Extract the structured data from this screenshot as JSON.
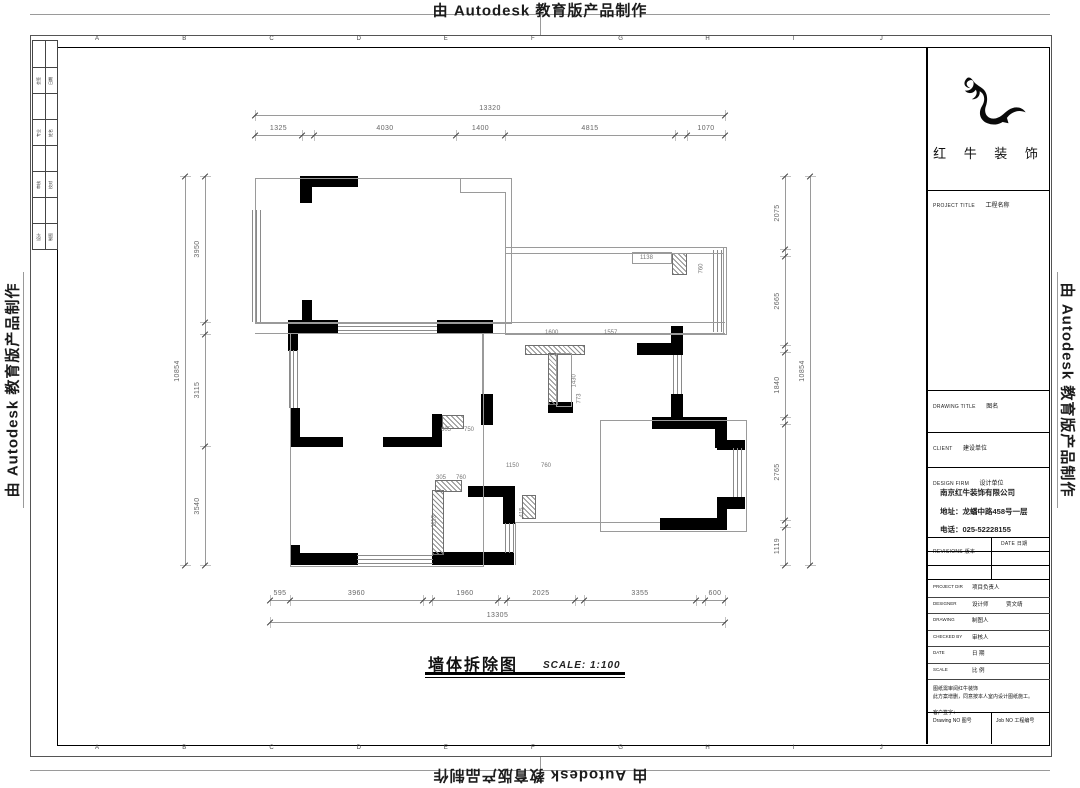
{
  "stamp_text": "由 Autodesk 教育版产品制作",
  "frame": {
    "grid_letters": [
      "A",
      "B",
      "C",
      "D",
      "E",
      "F",
      "G",
      "H",
      "I",
      "J"
    ],
    "side_rows": [
      [
        "会签",
        "日期"
      ],
      [
        "专业",
        "姓名"
      ],
      [
        "审核",
        "校对"
      ],
      [
        "设计",
        "制图"
      ]
    ]
  },
  "plan": {
    "title": "墙体拆除图",
    "scale_label": "SCALE: 1:100",
    "dim_chains": [
      {
        "dir": "h",
        "pos": 115,
        "ticks": [
          255,
          725
        ],
        "spans": [
          {
            "a": 255,
            "b": 725,
            "t": "13320"
          }
        ]
      },
      {
        "dir": "h",
        "pos": 135,
        "ticks": [
          255,
          302,
          314,
          456,
          505,
          675,
          687,
          725
        ],
        "spans": [
          {
            "a": 255,
            "b": 302,
            "t": "1325"
          },
          {
            "a": 314,
            "b": 456,
            "t": "4030"
          },
          {
            "a": 456,
            "b": 505,
            "t": "1400"
          },
          {
            "a": 505,
            "b": 675,
            "t": "4815"
          },
          {
            "a": 687,
            "b": 725,
            "t": "1070"
          }
        ]
      },
      {
        "dir": "h",
        "pos": 600,
        "ticks": [
          270,
          290,
          423,
          432,
          498,
          507,
          575,
          584,
          696,
          705,
          725
        ],
        "spans": [
          {
            "a": 270,
            "b": 290,
            "t": "595"
          },
          {
            "a": 290,
            "b": 423,
            "t": "3960"
          },
          {
            "a": 432,
            "b": 498,
            "t": "1960"
          },
          {
            "a": 507,
            "b": 575,
            "t": "2025"
          },
          {
            "a": 584,
            "b": 696,
            "t": "3355"
          },
          {
            "a": 705,
            "b": 725,
            "t": "600"
          }
        ]
      },
      {
        "dir": "h",
        "pos": 622,
        "ticks": [
          270,
          725
        ],
        "spans": [
          {
            "a": 270,
            "b": 725,
            "t": "13305"
          }
        ]
      },
      {
        "dir": "v",
        "pos": 185,
        "ticks": [
          176,
          565
        ],
        "spans": [
          {
            "a": 176,
            "b": 565,
            "t": "10854"
          }
        ]
      },
      {
        "dir": "v",
        "pos": 205,
        "ticks": [
          176,
          322,
          334,
          446,
          565
        ],
        "spans": [
          {
            "a": 176,
            "b": 322,
            "t": "3950"
          },
          {
            "a": 334,
            "b": 446,
            "t": "3115"
          },
          {
            "a": 446,
            "b": 565,
            "t": "3540"
          }
        ]
      },
      {
        "dir": "v",
        "pos": 785,
        "ticks": [
          176,
          249,
          256,
          345,
          352,
          417,
          424,
          520,
          527,
          565
        ],
        "spans": [
          {
            "a": 176,
            "b": 249,
            "t": "2075"
          },
          {
            "a": 256,
            "b": 345,
            "t": "2665"
          },
          {
            "a": 352,
            "b": 417,
            "t": "1840"
          },
          {
            "a": 424,
            "b": 520,
            "t": "2765"
          },
          {
            "a": 527,
            "b": 565,
            "t": "1119"
          }
        ]
      },
      {
        "dir": "v",
        "pos": 810,
        "ticks": [
          176,
          565
        ],
        "spans": [
          {
            "a": 176,
            "b": 565,
            "t": "10854"
          }
        ]
      }
    ],
    "inner_dims": [
      {
        "x": 545,
        "y": 330,
        "t": "1600"
      },
      {
        "x": 604,
        "y": 330,
        "t": "1557"
      },
      {
        "x": 563,
        "y": 372,
        "t": "1430",
        "v": 1
      },
      {
        "x": 640,
        "y": 255,
        "t": "1138"
      },
      {
        "x": 690,
        "y": 258,
        "t": "760",
        "v": 1
      },
      {
        "x": 441,
        "y": 427,
        "t": "605"
      },
      {
        "x": 464,
        "y": 427,
        "t": "750"
      },
      {
        "x": 436,
        "y": 475,
        "t": "305"
      },
      {
        "x": 456,
        "y": 475,
        "t": "760"
      },
      {
        "x": 423,
        "y": 512,
        "t": "1113",
        "v": 1
      },
      {
        "x": 511,
        "y": 502,
        "t": "415",
        "v": 1
      },
      {
        "x": 506,
        "y": 463,
        "t": "1150"
      },
      {
        "x": 541,
        "y": 463,
        "t": "760"
      },
      {
        "x": 568,
        "y": 388,
        "t": "773",
        "v": 1
      }
    ],
    "geometry": {
      "solid": [
        [
          300,
          176,
          58,
          11
        ],
        [
          300,
          176,
          12,
          27
        ],
        [
          288,
          320,
          50,
          13
        ],
        [
          302,
          300,
          10,
          21
        ],
        [
          288,
          333,
          10,
          18
        ],
        [
          437,
          320,
          56,
          13
        ],
        [
          637,
          343,
          46,
          12
        ],
        [
          671,
          326,
          12,
          29
        ],
        [
          548,
          402,
          25,
          11
        ],
        [
          671,
          394,
          12,
          24
        ],
        [
          652,
          417,
          73,
          12
        ],
        [
          715,
          417,
          12,
          31
        ],
        [
          717,
          440,
          28,
          10
        ],
        [
          717,
          497,
          28,
          12
        ],
        [
          717,
          497,
          10,
          33
        ],
        [
          660,
          518,
          65,
          12
        ],
        [
          290,
          408,
          10,
          39
        ],
        [
          298,
          437,
          45,
          10
        ],
        [
          383,
          437,
          58,
          10
        ],
        [
          432,
          414,
          10,
          33
        ],
        [
          290,
          545,
          10,
          20
        ],
        [
          290,
          553,
          68,
          12
        ],
        [
          432,
          552,
          82,
          13
        ],
        [
          468,
          486,
          47,
          11
        ],
        [
          503,
          486,
          12,
          38
        ],
        [
          481,
          394,
          12,
          31
        ]
      ],
      "hatch": [
        [
          525,
          345,
          58,
          8
        ],
        [
          548,
          353,
          8,
          50
        ],
        [
          442,
          415,
          20,
          12
        ],
        [
          432,
          490,
          10,
          63
        ],
        [
          672,
          253,
          13,
          20
        ],
        [
          435,
          480,
          25,
          10
        ],
        [
          522,
          495,
          12,
          22
        ]
      ],
      "windows": [
        [
          252,
          210,
          10,
          112,
          "v"
        ],
        [
          338,
          322,
          99,
          11,
          "h"
        ],
        [
          289,
          350,
          9,
          58,
          "v"
        ],
        [
          713,
          250,
          10,
          82,
          "v"
        ],
        [
          673,
          355,
          9,
          39,
          "v"
        ],
        [
          357,
          555,
          76,
          9,
          "h"
        ],
        [
          733,
          448,
          10,
          49,
          "v"
        ],
        [
          505,
          523,
          9,
          30,
          "v"
        ]
      ],
      "outlines": [
        [
          255,
          178,
          255,
          144
        ],
        [
          505,
          247,
          220,
          86
        ],
        [
          290,
          333,
          192,
          232
        ],
        [
          632,
          252,
          38,
          10
        ],
        [
          556,
          353,
          14,
          52
        ],
        [
          600,
          420,
          145,
          110
        ]
      ],
      "lines": [
        [
          255,
          322,
          470,
          1
        ],
        [
          255,
          333,
          470,
          1
        ],
        [
          505,
          253,
          218,
          1
        ],
        [
          460,
          178,
          1,
          14
        ],
        [
          460,
          192,
          45,
          1
        ],
        [
          505,
          192,
          1,
          56
        ],
        [
          723,
          247,
          1,
          86
        ],
        [
          290,
          447,
          1,
          106
        ],
        [
          482,
          333,
          1,
          61
        ],
        [
          515,
          522,
          145,
          1
        ],
        [
          515,
          522,
          1,
          43
        ]
      ]
    }
  },
  "title_block": {
    "logo_name": "红 牛 装 饰",
    "rows": [
      {
        "en": "PROJECT TITLE",
        "zh": "工程名称"
      },
      {
        "en": "DRAWING TITLE",
        "zh": "图名"
      },
      {
        "en": "CLIENT",
        "zh": "建设单位"
      },
      {
        "en": "DESIGN FIRM",
        "zh": "设计单位"
      }
    ],
    "company": {
      "name": "南京红牛装饰有限公司",
      "address": "地址：龙蟠中路458号一层",
      "phone": "电话：025-52228155"
    },
    "revisions": {
      "rev_header": "REVISIONS 版本",
      "date_header": "DATE 日期"
    },
    "info_rows": [
      {
        "en": "PROJECT DIR",
        "zh": "项目负责人",
        "val": ""
      },
      {
        "en": "DESIGNER",
        "zh": "设计师",
        "val": "贾文靖"
      },
      {
        "en": "DRAWING",
        "zh": "制图人",
        "val": ""
      },
      {
        "en": "CHECKED BY",
        "zh": "审核人",
        "val": ""
      },
      {
        "en": "DATE",
        "zh": "日 期",
        "val": ""
      },
      {
        "en": "SCALE",
        "zh": "比 例",
        "val": ""
      }
    ],
    "note1": "图纸需审阅红牛装饰",
    "note2": "此方案增删，同意按本人室内设计图纸施工。",
    "signature": "客户签字：",
    "drawing_no": "Drawing NO 图号",
    "job_no": "Job NO 工程编号"
  }
}
